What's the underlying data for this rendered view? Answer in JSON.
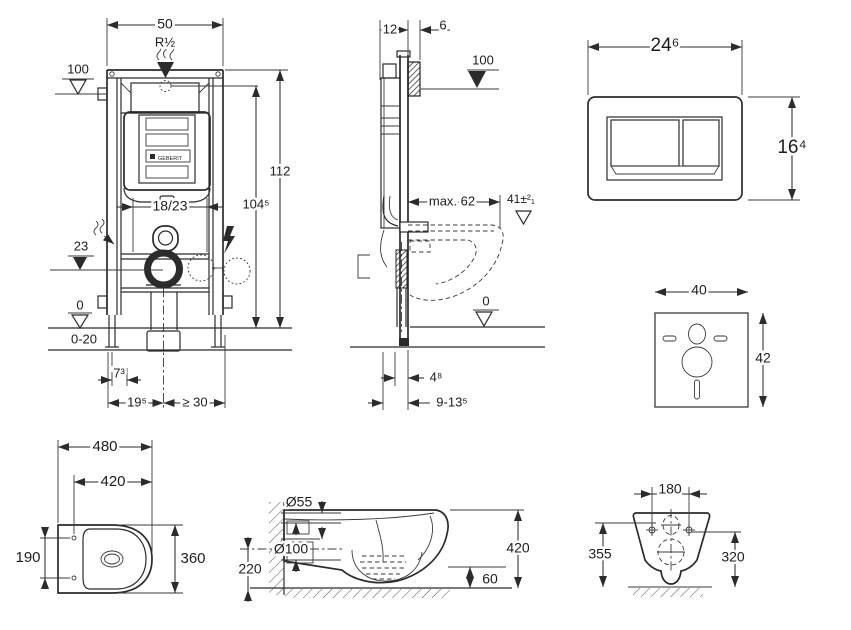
{
  "front_view": {
    "width": "50",
    "inlet_thread": "R½",
    "ref_height": "100",
    "total_height": "112",
    "flush_center_height": "104⁵",
    "depth_options": "18/23",
    "outlet_level": "23",
    "floor_level": "0",
    "floor_buildup": "0-20",
    "foot_offset": "7³",
    "axis_left": "19⁵",
    "axis_right": "≥ 30",
    "logo": "GEBERIT"
  },
  "side_view": {
    "frame_depth": "12",
    "front_offset": "6",
    "ref_height": "100",
    "bowl_depth_max": "max. 62",
    "seat_height": "41±²₁",
    "floor_level": "0",
    "bottom_offset": "4⁸",
    "bottom_range": "9-13⁵"
  },
  "flush_plate": {
    "width": "24⁶",
    "height": "16⁴"
  },
  "sound_pad": {
    "width": "40",
    "height": "42"
  },
  "toilet_top_view": {
    "length": "480",
    "seat_length": "420",
    "hole_spacing": "190",
    "width": "360"
  },
  "toilet_side_view": {
    "inlet_diameter": "Ø55",
    "outlet_diameter": "Ø100",
    "outlet_height": "220",
    "height": "420",
    "bottom_clearance": "60"
  },
  "toilet_back_view": {
    "hole_spacing": "180",
    "height_left": "355",
    "height_right": "320"
  }
}
